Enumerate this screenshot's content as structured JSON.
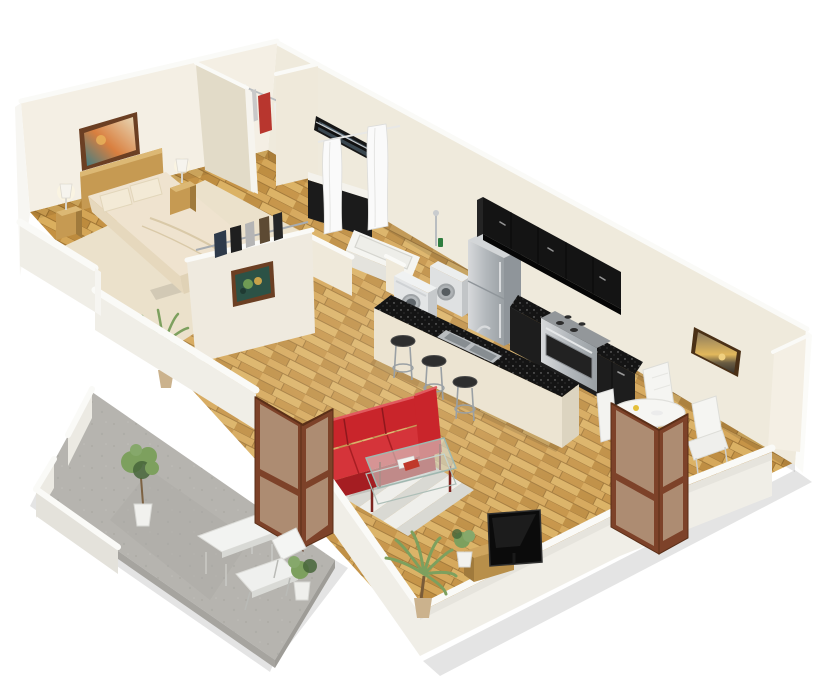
{
  "scene": {
    "title": "3D isometric cutaway floor plan render of a one-bedroom apartment",
    "view": "isometric cutaway, white background, no visible text"
  },
  "palette": {
    "bg": "#ffffff",
    "wall": "#efe9da",
    "wall_light": "#f4efe4",
    "wall_shade": "#e2dbc8",
    "wall_top": "#fafaf7",
    "wall_outer": "#f0eee7",
    "wood_a": "#d2a04c",
    "wood_b": "#c18b38",
    "wood_c": "#d8ab57",
    "wood_d": "#b98432",
    "wood_line": "#9a6d28",
    "carpet": "#eadfc7",
    "concrete": "#b6b4af",
    "concrete_dark": "#a19f9a",
    "sofa": "#c9252b",
    "sofa_dark": "#a51d22",
    "sofa_light": "#d5343a",
    "cabinet_black": "#141414",
    "cabinet_black_light": "#1d1d1d",
    "steel": "#b9bdc0",
    "steel_dark": "#8f959a",
    "steel_light": "#dfe1e2",
    "door_wood": "#7d4229",
    "door_wood_dark": "#5a2f18",
    "glass": "#d6cbae",
    "white_furniture": "#f5f5f2",
    "white_furniture_shade": "#d9dad6",
    "rug_a": "#efefeb",
    "rug_b": "#d9d9d3",
    "plant_green": "#7da05e",
    "plant_dark": "#46653a",
    "frame_wood": "#6b3f23",
    "pot": "#cbb28d",
    "wood_furniture": "#c69a52",
    "wood_furniture_dark": "#a07a3c",
    "wood_furniture_light": "#dcb874"
  },
  "rooms": [
    {
      "id": "bedroom",
      "label": "Bedroom",
      "floor": "beige carpet",
      "items": [
        "double bed with cream bedding",
        "wood headboard",
        "two pillows",
        "left nightstand",
        "right nightstand",
        "two white table lamps",
        "landscape wall art",
        "half wall with clothes rail"
      ]
    },
    {
      "id": "walk-in-closet",
      "label": "Walk-in closet",
      "floor": "wood",
      "items": [
        "clothes rail",
        "hanging garments (white, red, gray)"
      ]
    },
    {
      "id": "bathroom",
      "label": "Bathroom",
      "floor": "wood",
      "items": [
        "black vanity with white top",
        "mirror",
        "white shower curtains",
        "bathtub",
        "shower fixture"
      ]
    },
    {
      "id": "laundry",
      "label": "Laundry nook",
      "floor": "wood",
      "items": [
        "washing machine",
        "dryer"
      ]
    },
    {
      "id": "kitchen",
      "label": "Kitchen",
      "floor": "wood",
      "items": [
        "stainless refrigerator",
        "black upper cabinets",
        "black lower cabinets with stove",
        "island with black counter",
        "stainless double sink",
        "three bar stools"
      ]
    },
    {
      "id": "living-room",
      "label": "Living room",
      "floor": "wood",
      "items": [
        "red three-seat sofa",
        "glass coffee table with magazines",
        "striped area rug",
        "flat screen TV",
        "wood TV stand",
        "two palm plants",
        "small potted plant",
        "abstract wall art"
      ]
    },
    {
      "id": "dining",
      "label": "Dining area",
      "floor": "wood",
      "items": [
        "round white table",
        "three white chairs",
        "sunset wall art",
        "folding glass door"
      ]
    },
    {
      "id": "patio",
      "label": "Patio",
      "floor": "concrete",
      "items": [
        "low parapet walls",
        "folding glass door",
        "white lounge chair",
        "white side table",
        "potted tree",
        "potted shrub"
      ]
    }
  ]
}
